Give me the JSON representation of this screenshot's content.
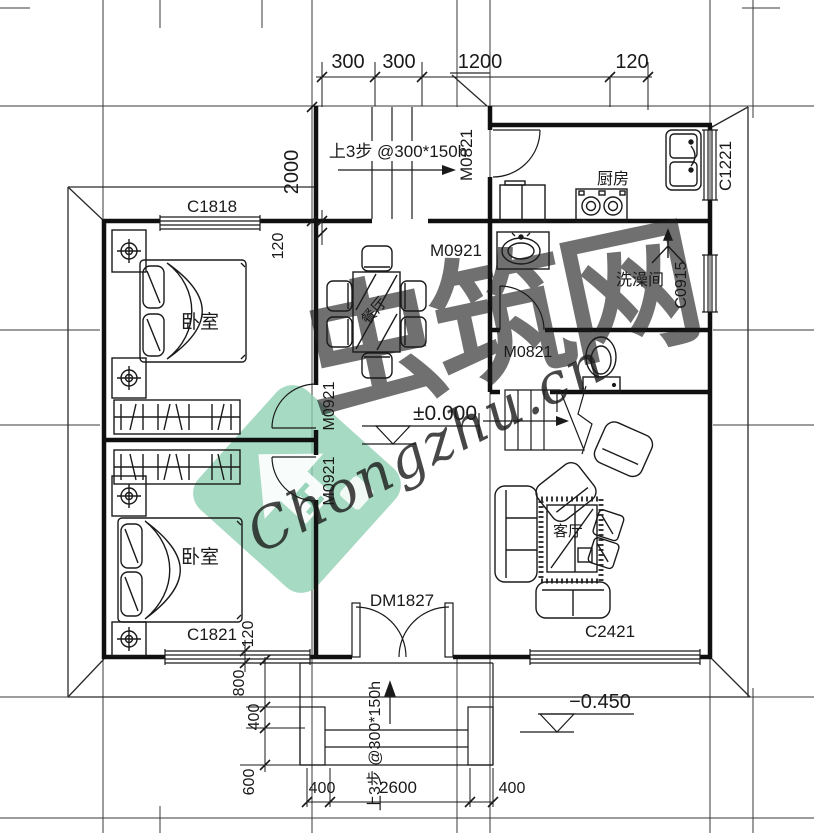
{
  "watermark": {
    "brand_cn": "虫筑网",
    "brand_en": "Chongzhu.cn",
    "logo_color": "#8ed0b2"
  },
  "rooms": {
    "bedroom_top": "卧室",
    "bedroom_bottom": "卧室",
    "dining": "餐厅",
    "kitchen": "厨房",
    "shower": "洗澡间",
    "living": "客厅"
  },
  "doors": {
    "kitchen_door": "M0821",
    "shower_door": "M0821",
    "dining_door": "M0921",
    "bedroom_top_door": "M0921",
    "bedroom_bottom_door": "M0921",
    "entry_door": "DM1827"
  },
  "windows": {
    "c1818": "C1818",
    "c1221": "C1221",
    "c0915": "C0915",
    "c1821": "C1821",
    "c2421": "C2421"
  },
  "levels": {
    "indoor": "±0.000",
    "outdoor": "−0.450"
  },
  "notes": {
    "stair_up_top": "上3步 @300*150h",
    "stair_up_entry": "上3步 @300*150h"
  },
  "dims": {
    "top": {
      "d1": "300",
      "d2": "300",
      "d3": "1200",
      "d4": "120"
    },
    "left_vertical": "2000",
    "wall_top": "120",
    "wall_bottom": "120",
    "entry_vertical": {
      "d1": "800",
      "d2": "400",
      "d3": "600"
    },
    "entry_horizontal": {
      "d1": "400",
      "d2": "2600",
      "d3": "400"
    }
  }
}
